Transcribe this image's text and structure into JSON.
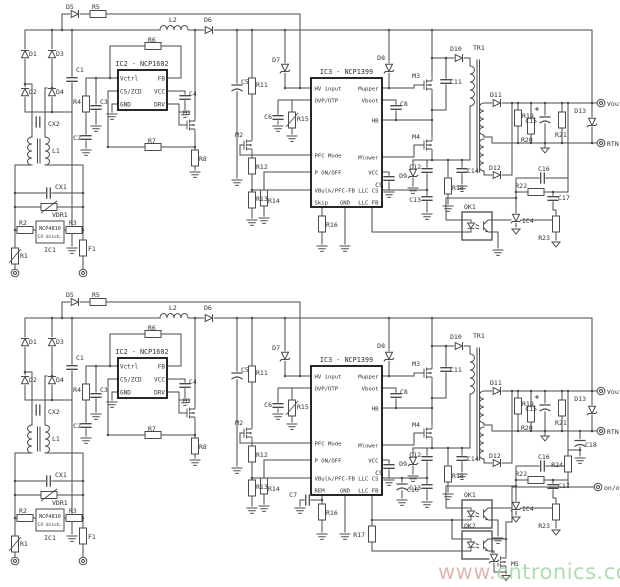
{
  "watermark": {
    "prefix": "www.",
    "rest": "cntronics.com",
    "prefix_color": "#dba5a1",
    "rest_color": "#9bd3a0"
  },
  "terminals": {
    "vout": "Vout",
    "rtn": "RTN",
    "onoff": "on/off"
  },
  "ic1": {
    "part": "NCP4810",
    "subtitle": "CX disch.",
    "ref": "IC1"
  },
  "ic2": {
    "title": "IC2 - NCP1602",
    "pin_vctrl": "Vctrl",
    "pin_cszcd": "CS/ZCD",
    "pin_gnd": "GND",
    "pin_fb": "FB",
    "pin_vcc": "VCC",
    "pin_drv": "DRV"
  },
  "ic3": {
    "title": "IC3 - NCP1399",
    "pin_hv": "HV input",
    "pin_ovp": "OVP/OTP",
    "pin_pfc": "PFC Mode",
    "pin_ponoff": "P ON/OFF",
    "pin_vbulk": "VBulk/PFC-FB",
    "pin_gnd": "GND",
    "pin_llcfb": "LLC FB",
    "pin_mupper": "Mupper",
    "pin_vboot": "Vboot",
    "pin_hb": "HB",
    "pin_mlower": "Mlower",
    "pin_vcc": "VCC",
    "pin_llccs": "LLC CS"
  },
  "top_variant": {
    "mode_pin": "Skip"
  },
  "bottom_variant": {
    "mode_pin": "REM"
  },
  "refs": {
    "d1": "D1",
    "d2": "D2",
    "d3": "D3",
    "d4": "D4",
    "d5": "D5",
    "d6": "D6",
    "d7": "D7",
    "d8": "D8",
    "d9": "D9",
    "d10": "D10",
    "d11": "D11",
    "d12": "D12",
    "d13": "D13",
    "r1": "R1",
    "r2": "R2",
    "r3": "R3",
    "r4": "R4",
    "r5": "R5",
    "r6": "R6",
    "r7": "R7",
    "r8": "R8",
    "r11": "R11",
    "r12": "R12",
    "r13": "R13",
    "r14": "R14",
    "r15": "R15",
    "r16": "R16",
    "r17": "R17",
    "r18": "R18",
    "r19": "R19",
    "r20": "R20",
    "r21": "R21",
    "r22": "R22",
    "r23": "R23",
    "r24": "R24",
    "c1": "C1",
    "c2": "C2",
    "c3": "C3",
    "c4": "C4",
    "c5": "C5",
    "c6": "C6",
    "c7": "C7",
    "c8": "C8",
    "c9": "C9",
    "c10": "C10",
    "c11": "C11",
    "c12": "C12",
    "c13": "C13",
    "c14": "C14",
    "c15": "C15",
    "c16": "C16",
    "c17": "C17",
    "c18": "C18",
    "cx1": "CX1",
    "cx2": "CX2",
    "l1": "L1",
    "l2": "L2",
    "vdr1": "VDR1",
    "f1": "F1",
    "tr1": "TR1",
    "m1": "M1",
    "m2": "M2",
    "m3": "M3",
    "m4": "M4",
    "m5": "M5",
    "ok1": "OK1",
    "ok2": "OK2",
    "ic4": "IC4"
  }
}
